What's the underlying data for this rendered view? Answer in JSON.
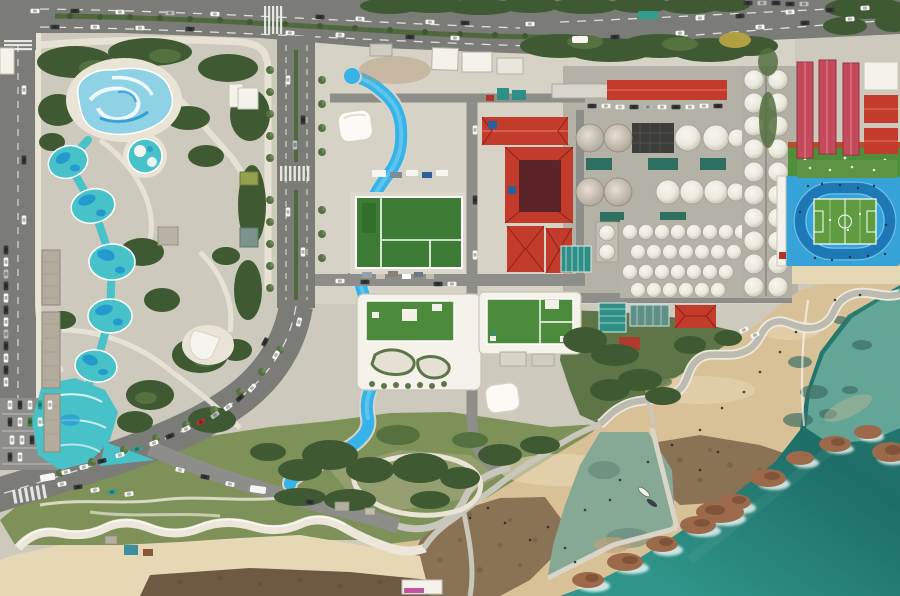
{
  "scene": {
    "type": "aerial-photograph",
    "subject": "coastal water park, bottling/tank facility with red roofs, blue running-track stadium, winding beach promenade and rocky teal shoreline",
    "features": [
      {
        "name": "water-park",
        "detail": "swirl wave pool, round kiddie pool, chain of 5 teal splash pools, wide lazy-river pool"
      },
      {
        "name": "water-slide-canal",
        "detail": "bright blue winding canal from top road to park near beach"
      },
      {
        "name": "sports-courts",
        "detail": "green courts with white lines"
      },
      {
        "name": "green-roof-buildings",
        "count": 2
      },
      {
        "name": "red-roof-industrial-buildings",
        "count_approx": 6
      },
      {
        "name": "white-storage-tanks",
        "count_approx": 60
      },
      {
        "name": "stadium",
        "detail": "blue running track around green soccer pitch"
      },
      {
        "name": "coastal-promenade",
        "detail": "S-curved gray path over sand"
      },
      {
        "name": "breakwater-jetty-and-tidal-pool",
        "boats": 2
      },
      {
        "name": "rocky-shore-with-surf"
      },
      {
        "name": "highway-top",
        "cars_approx": 30
      },
      {
        "name": "curving-coastal-road",
        "parked_cars_approx": 20
      },
      {
        "name": "parking-lot-southwest"
      }
    ]
  },
  "palette": {
    "plaza": "#cdc9bc",
    "plaza2": "#d6d2c5",
    "path-light": "#e9e4d6",
    "road": "#7b7b77",
    "road-light": "#8d8d89",
    "lane-white": "#f2f2ee",
    "median-green": "#4e6a3d",
    "tree-dark": "#3f5a33",
    "tree-mid": "#55713f",
    "grass": "#7d9158",
    "olive": "#a0a478",
    "scrub": "#5d7547",
    "pool-teal": "#46c2c8",
    "pool-deep": "#1f92d2",
    "pool-light": "#8fd2e6",
    "swirl-white": "#eefaff",
    "canal-blue": "#36b3e8",
    "canal-light": "#7fd4f2",
    "canal-edge": "#d8d4c8",
    "red-roof": "#c23b2b",
    "red-roof-dark": "#8e2318",
    "maroon": "#5a2428",
    "pink-roof": "#c54a5c",
    "tank-base": "#b4b1a6",
    "dark-roof": "#3d3d3a",
    "teal-roof": "#2e8f86",
    "teal-roof-dark": "#2f6f5f",
    "green-roof": "#4c8a3c",
    "court-green": "#3c7c35",
    "white-struct": "#f4f2ea",
    "track-blue": "#35a2d8",
    "track-lane": "#1e78b6",
    "pitch-green": "#5f9c40",
    "sand": "#d9c197",
    "sand-light": "#e7d8b5",
    "sand-wet": "#bda17a",
    "flat-brown": "#8a7254",
    "flat-dark": "#6e5a43",
    "rock-brown": "#9c6a4a",
    "rock-dark": "#7a4f35",
    "foam": "#ffffff",
    "sea-deep": "#1d6e67",
    "sea-mid": "#27857c",
    "lagoon": "#6fae9d",
    "pool-murky": "#85a995",
    "seawall": "#ece7da",
    "jetty": "#d9d5c8",
    "car-white": "#f5f5f2",
    "car-dark": "#35383c",
    "car-silver": "#b9bcbe",
    "car-red": "#b33327",
    "car-blue": "#2d5f9e",
    "car-teal": "#2e9e8f"
  }
}
